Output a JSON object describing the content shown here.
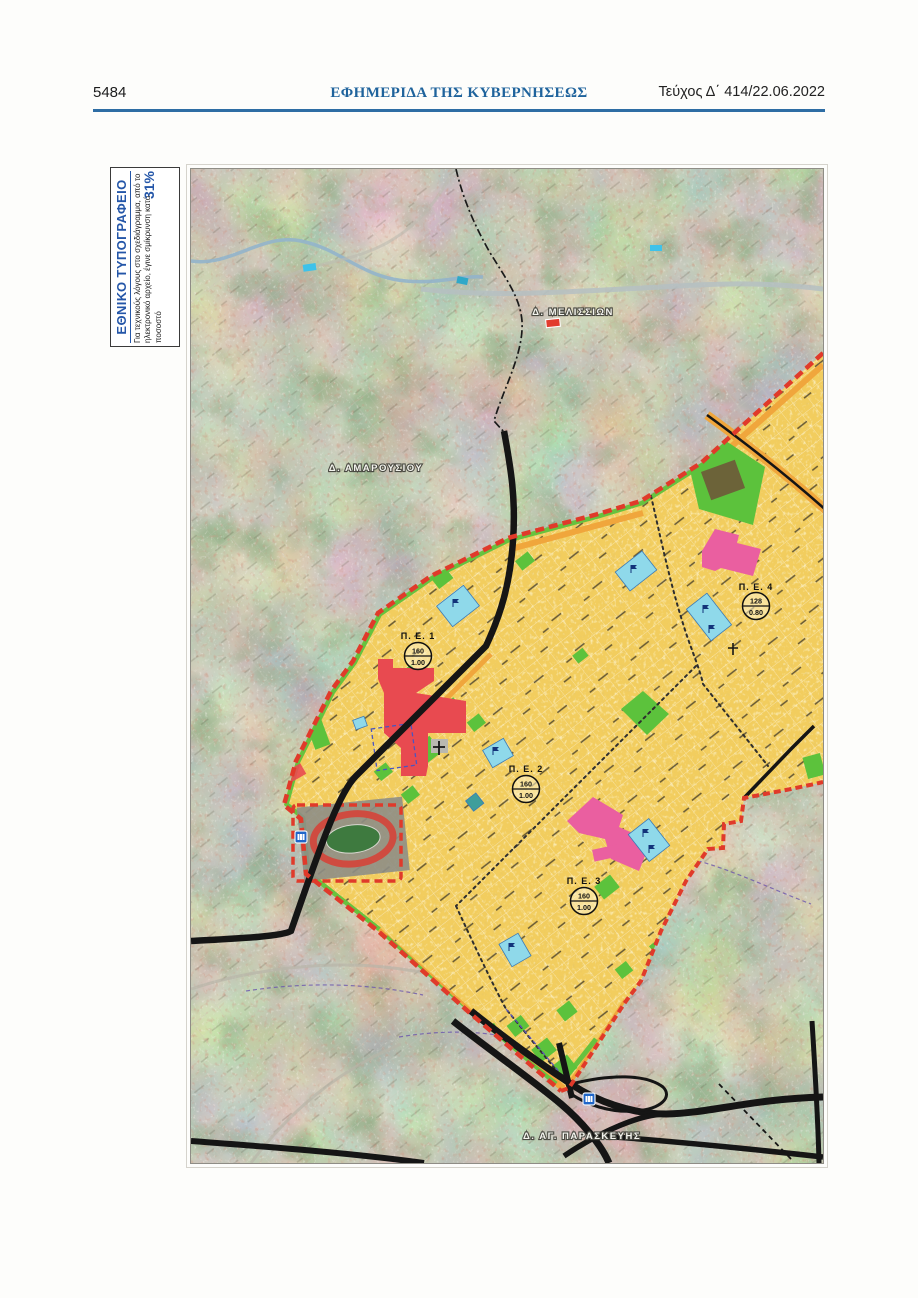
{
  "page": {
    "number": "5484",
    "gazette_title": "ΕΦΗΜΕΡΙΔΑ ΤΗΣ ΚΥΒΕΡΝΗΣΕΩΣ",
    "issue": "Τεύχος Δ΄ 414/22.06.2022"
  },
  "stamp": {
    "org": "ΕΘΝΙΚΟ ΤΥΠΟΓΡΑΦΕΙΟ",
    "note": "Για τεχνικούς λόγους στο σχεδιάγραμμα, από το ηλεκτρονικό αρχείο, έγινε σμίκρυνση κατά ποσοστό",
    "percent": "31%"
  },
  "map": {
    "municipalities": [
      {
        "name": "Δ. ΜΕΛΙΣΣΙΩΝ"
      },
      {
        "name": "Δ. ΑΜΑΡΟΥΣΙΟΥ"
      },
      {
        "name": "Δ. ΑΓ. ΠΑΡΑΣΚΕΥΗΣ"
      }
    ],
    "zones": [
      {
        "label": "Π. Ε. 1",
        "value_top": "160",
        "value_bottom": "1.00"
      },
      {
        "label": "Π. Ε. 2",
        "value_top": "160",
        "value_bottom": "1.00"
      },
      {
        "label": "Π. Ε. 3",
        "value_top": "160",
        "value_bottom": "1.00"
      },
      {
        "label": "Π. Ε. 4",
        "value_top": "128",
        "value_bottom": "0.80"
      }
    ],
    "colors": {
      "zone_fill": "#f2cd5e",
      "green_area": "#5cc23c",
      "red_block": "#e84a50",
      "pink_block": "#ea5fa0",
      "cyan_block": "#8fd9ea",
      "orange_strip": "#f0a63c",
      "boundary_red": "#e03a2a",
      "road_black": "#151515"
    }
  }
}
